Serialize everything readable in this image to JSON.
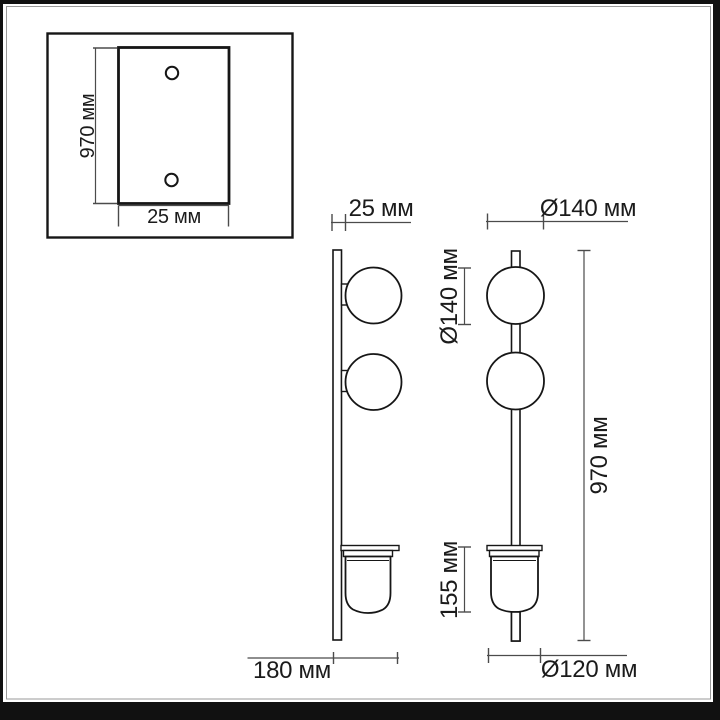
{
  "page": {
    "background": "#ffffff",
    "frame_color": "#111111"
  },
  "drawing": {
    "title": "wall-lamp-dimension-drawing",
    "outline_color": "#161616",
    "dim_color": "#4b4b4b",
    "text_color": "#1b1b1b",
    "unit": "мм"
  },
  "inset_view": {
    "plate_height": "970 мм",
    "plate_width": "25 мм"
  },
  "side_view": {
    "plate_depth": "25 мм",
    "globe_diameter": "Ø140 мм",
    "shade_height": "155 мм",
    "wall_projection": "180 мм"
  },
  "front_view": {
    "globe_diameter": "Ø140 мм",
    "total_height": "970 мм",
    "shade_diameter": "Ø120 мм"
  }
}
